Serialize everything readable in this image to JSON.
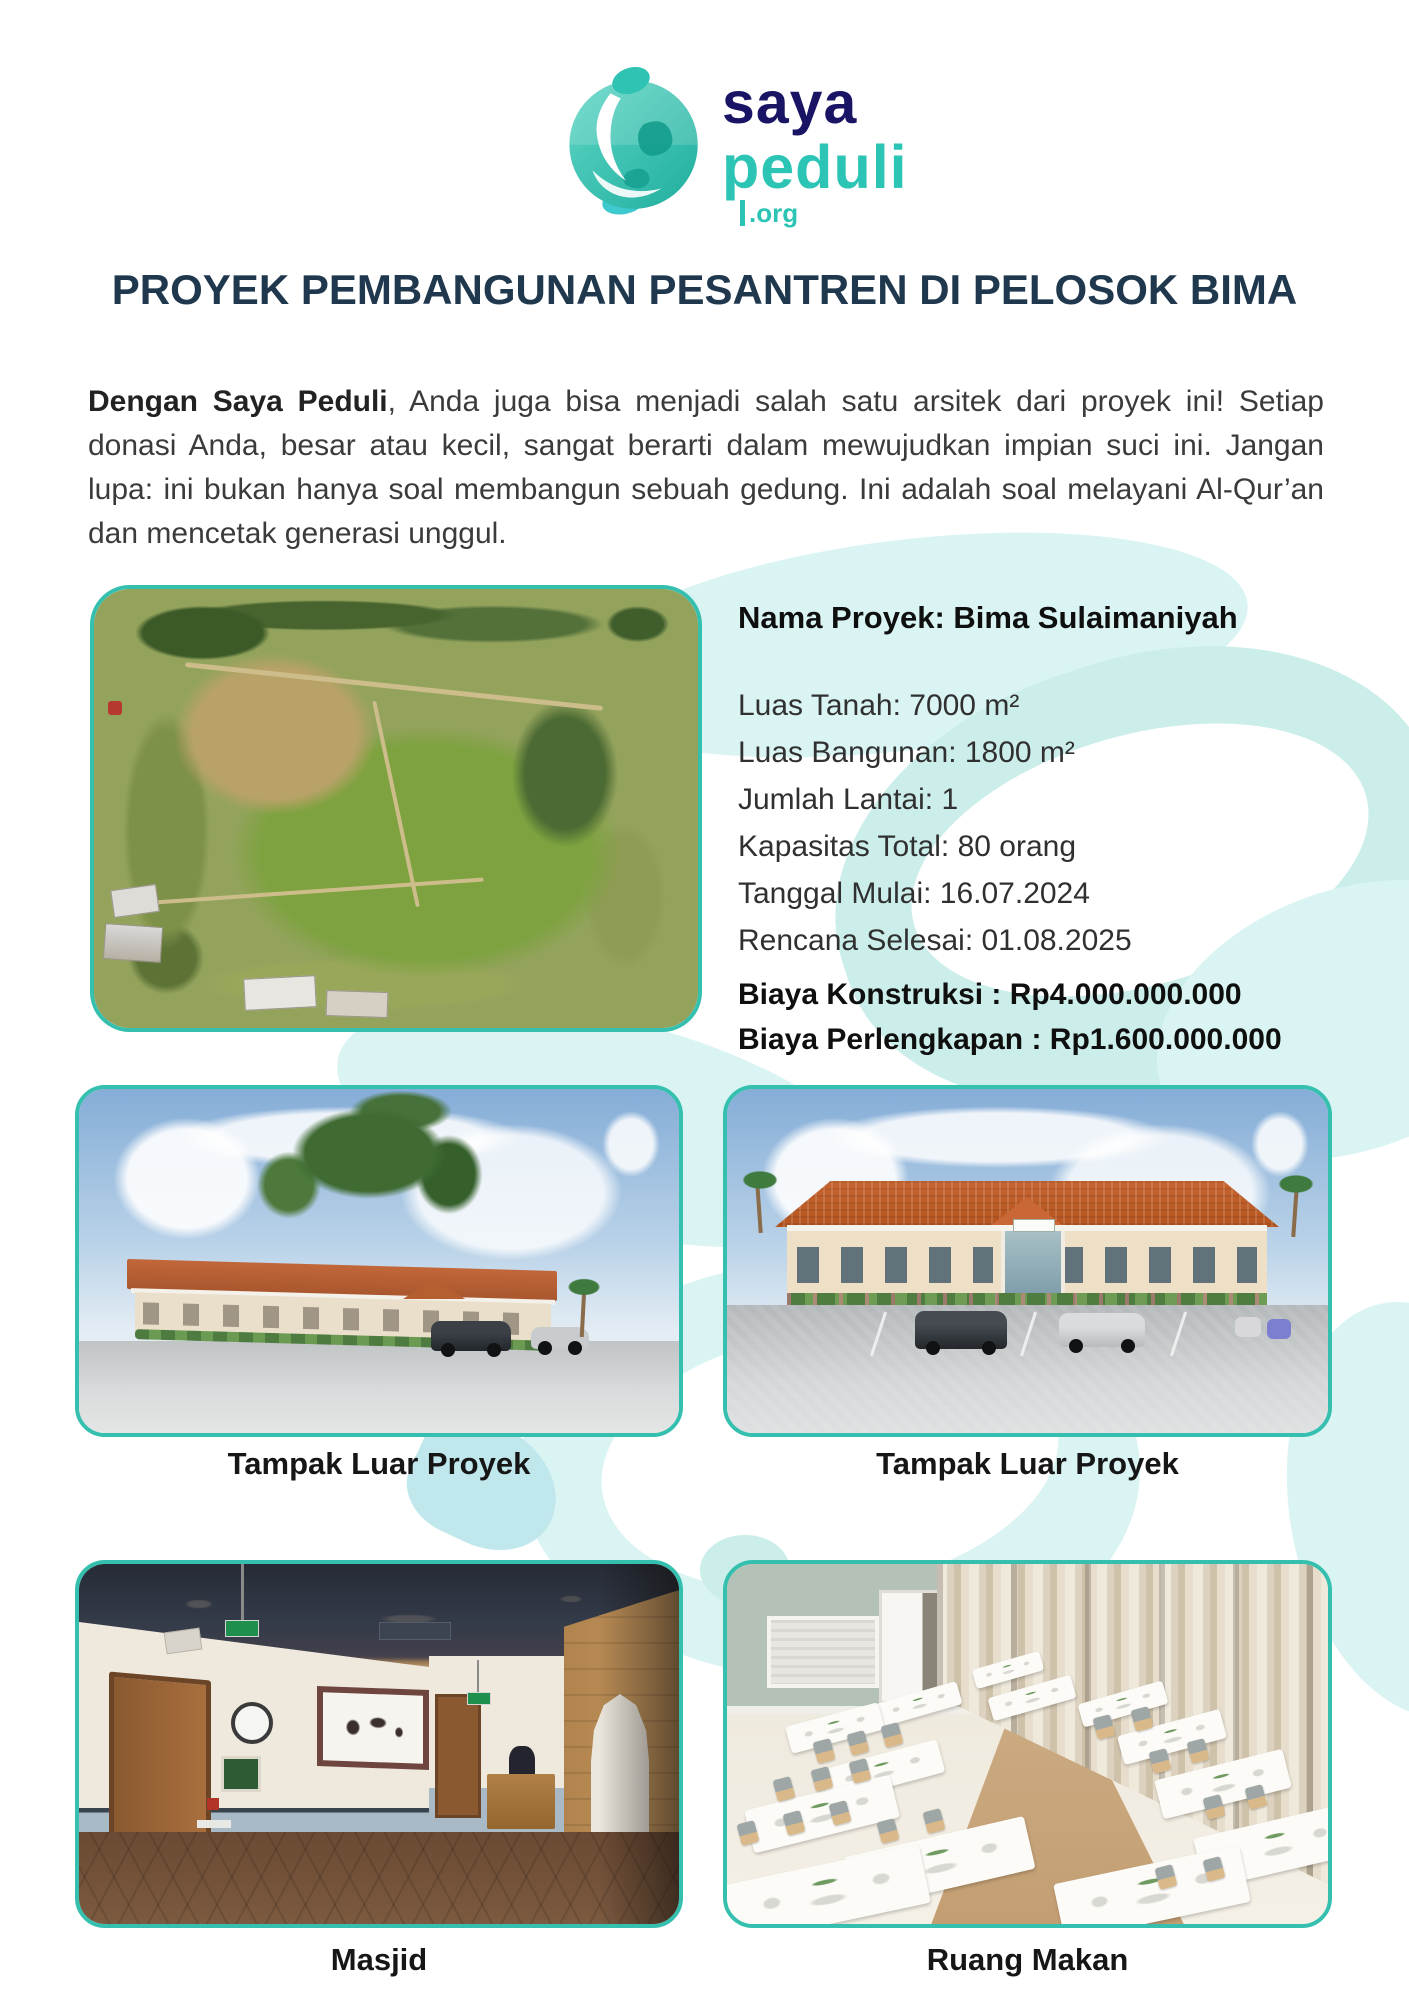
{
  "theme": {
    "accent_teal": "#34bfae",
    "logo_navy": "#1a1464",
    "logo_teal": "#2cc4b4",
    "title_color": "#20384e",
    "swirl_light": "#d9f4f3",
    "swirl_mid": "#cceeea"
  },
  "logo": {
    "brand_line1": "saya",
    "brand_line2": "peduli",
    "brand_suffix": ".org",
    "icon": "globe-person-icon"
  },
  "title": "PROYEK PEMBANGUNAN PESANTREN DI PELOSOK BIMA",
  "intro": {
    "lead_bold": "Dengan Saya Peduli",
    "rest": ", Anda juga bisa menjadi salah satu arsitek dari proyek ini! Setiap donasi Anda, besar atau kecil, sangat berarti dalam mewujudkan impian suci ini.  Jangan lupa: ini bukan hanya soal membangun sebuah gedung. Ini adalah soal melayani Al-Qur’an dan mencetak generasi unggul."
  },
  "project": {
    "name_label": "Nama Proyek: Bima Sulaimaniyah",
    "specs": [
      "Luas Tanah: 7000 m²",
      "Luas Bangunan: 1800 m²",
      "Jumlah Lantai: 1",
      "Kapasitas Total: 80 orang",
      "Tanggal Mulai: 16.07.2024",
      "Rencana Selesai: 01.08.2025"
    ],
    "costs": [
      "Biaya Konstruksi : Rp4.000.000.000",
      "Biaya Perlengkapan : Rp1.600.000.000"
    ]
  },
  "gallery": {
    "captions": {
      "mid_left": "Tampak Luar Proyek",
      "mid_right": "Tampak Luar Proyek",
      "bottom_left": "Masjid",
      "bottom_right": "Ruang Makan"
    }
  }
}
